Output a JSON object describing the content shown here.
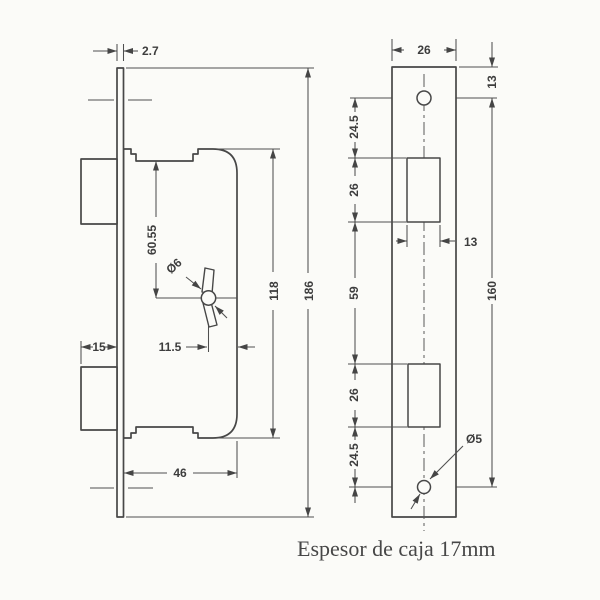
{
  "caption": "Espesor de caja 17mm",
  "side_view": {
    "faceplate_thickness": "2.7",
    "faceplate_height": "186",
    "case_height": "118",
    "top_to_spindle": "60.55",
    "spindle_diameter": "Ø6",
    "spindle_to_case_edge": "11.5",
    "bolt_protrusion": "15",
    "case_depth": "46"
  },
  "front_view": {
    "faceplate_width": "26",
    "top_to_screw": "13",
    "screw_to_hole_top": "24.5",
    "upper_hole_height": "26",
    "hole_width": "13",
    "between_holes": "59",
    "screw_spacing": "160",
    "lower_hole_height": "26",
    "hole_to_screw_bottom": "24.5",
    "screw_diameter": "Ø5"
  }
}
